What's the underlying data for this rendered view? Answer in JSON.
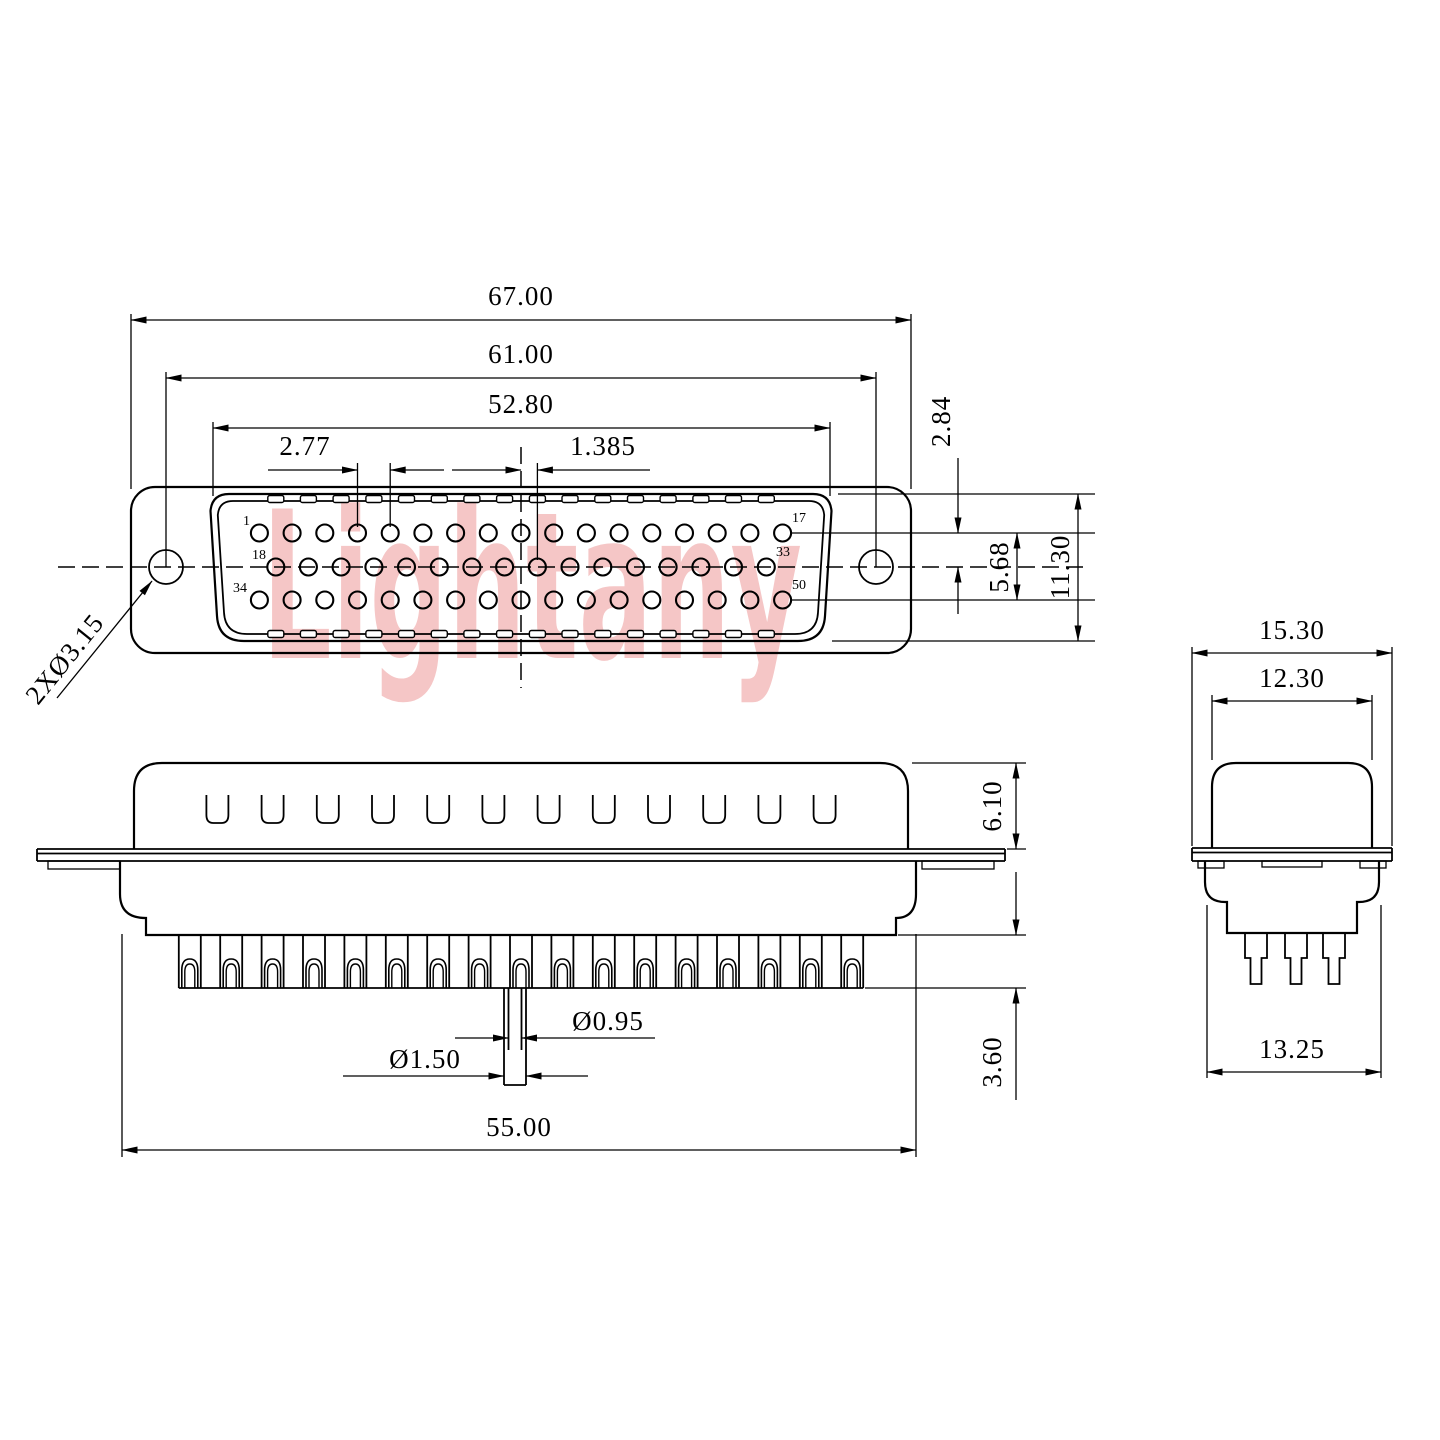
{
  "watermark": {
    "text": "Lightany",
    "color": "#f5c6c6"
  },
  "drawing": {
    "background": "#ffffff",
    "line_color": "#000000",
    "front_view": {
      "dimensions": {
        "overall_width": "67.00",
        "hole_spacing": "61.00",
        "shell_width": "52.80",
        "pin_pitch": "2.77",
        "half_pitch": "1.385",
        "row_spacing": "2.84",
        "row1_to_row3": "5.68",
        "shell_height": "11.30",
        "mounting_hole": "2XØ3.15"
      },
      "pin_labels": {
        "row1_start": "1",
        "row1_end": "17",
        "row2_start": "18",
        "row2_end": "33",
        "row3_start": "34",
        "row3_end": "50"
      },
      "pin_rows": [
        {
          "count": 17
        },
        {
          "count": 16
        },
        {
          "count": 17
        }
      ],
      "tick_count": 16
    },
    "side_view": {
      "dimensions": {
        "shell_height": "6.10",
        "pin_tail_length": "3.60",
        "body_width": "55.00",
        "pin_diameter": "Ø0.95",
        "pin_base_diameter": "Ø1.50"
      },
      "slot_count": 12,
      "pin_count": 17
    },
    "end_view": {
      "dimensions": {
        "flange_width": "15.30",
        "shell_width": "12.30",
        "body_width": "13.25"
      },
      "pin_count": 3
    }
  }
}
